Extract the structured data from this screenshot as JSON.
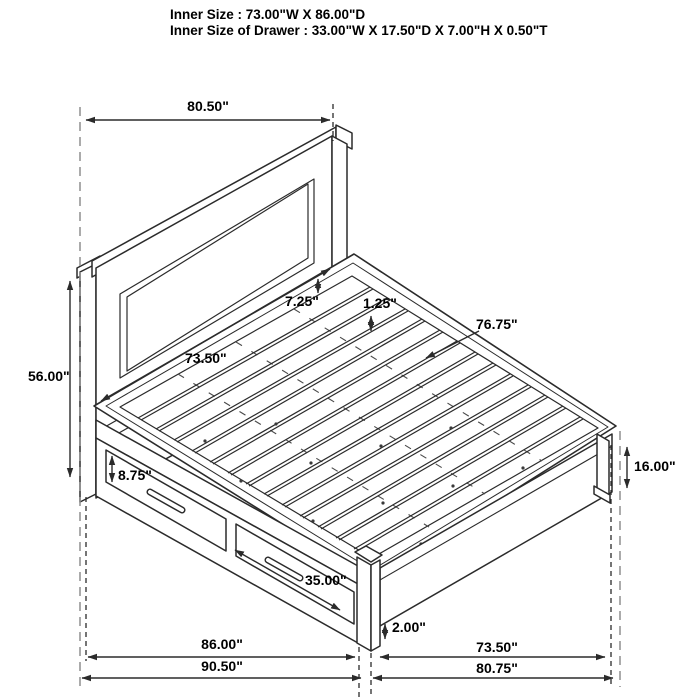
{
  "header": {
    "inner_size": "Inner Size : 73.00\"W X 86.00\"D",
    "inner_size_drawer": "Inner Size of Drawer : 33.00\"W X 17.50\"D X 7.00\"H X 0.50\"T"
  },
  "dimensions": {
    "headboard_width": "80.50\"",
    "headboard_height": "56.00\"",
    "headboard_panel_offset": "7.25\"",
    "slat_thickness": "1.25\"",
    "slat_length": "76.75\"",
    "headboard_inner_width": "73.50\"",
    "drawer_front_height": "8.75\"",
    "drawer_front_width": "35.00\"",
    "footboard_height": "16.00\"",
    "leg_height": "2.00\"",
    "side_rail_length": "86.00\"",
    "overall_depth": "90.50\"",
    "foot_rail_length": "73.50\"",
    "overall_width": "80.75\""
  },
  "colors": {
    "line": "#2b2b2b",
    "hidden_line": "#8f8f8f",
    "text": "#000000",
    "background": "#ffffff"
  }
}
